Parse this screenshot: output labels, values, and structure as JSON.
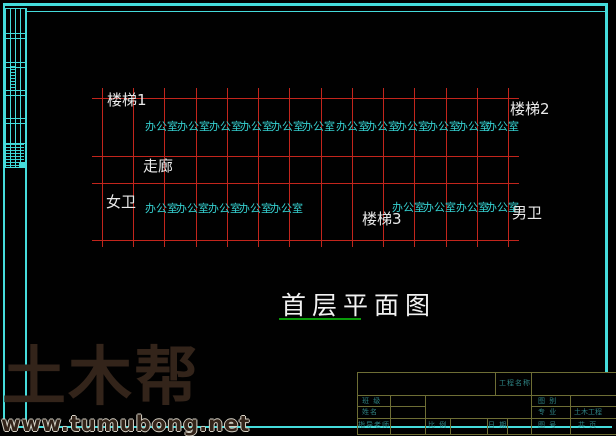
{
  "colors": {
    "frame_cyan": "#45dcdc",
    "grid_red": "#c2251c",
    "office_cyan": "#35cfcf",
    "label_white": "#eaeaea",
    "underline_green": "#0a9b0a",
    "block_line": "#6e6e35",
    "block_text": "#2f8484",
    "watermark_brown": "#33241a",
    "watermark_outline": "#d6d2c6"
  },
  "plan": {
    "grid": {
      "x_lines": [
        102,
        133,
        164,
        196,
        227,
        258,
        289,
        321,
        352,
        383,
        414,
        446,
        477,
        508
      ],
      "y_lines": [
        98,
        156,
        183,
        240
      ],
      "v_top": 88,
      "v_bottom": 247,
      "h_left": 92,
      "h_right": 519
    },
    "office_label": "办公室",
    "office_rows": [
      {
        "y": 121,
        "xs": [
          145,
          177,
          209,
          240,
          271,
          302,
          336,
          366,
          396,
          427,
          457,
          486
        ]
      },
      {
        "y": 203,
        "xs": [
          145,
          176,
          208,
          239,
          270
        ]
      },
      {
        "y": 202,
        "xs": [
          392,
          423,
          456,
          486
        ]
      }
    ],
    "room_labels": [
      {
        "id": "stair-1",
        "text": "楼梯1",
        "x": 107,
        "y": 92
      },
      {
        "id": "stair-2",
        "text": "楼梯2",
        "x": 510,
        "y": 101
      },
      {
        "id": "corridor",
        "text": "走廊",
        "x": 143,
        "y": 158
      },
      {
        "id": "female-wc",
        "text": "女卫",
        "x": 106,
        "y": 194
      },
      {
        "id": "stair-3",
        "text": "楼梯3",
        "x": 362,
        "y": 211
      },
      {
        "id": "male-wc",
        "text": "男卫",
        "x": 512,
        "y": 205
      }
    ],
    "title": {
      "text": "首层平面图",
      "x": 281,
      "y": 293,
      "underline_x": 279,
      "underline_y": 318,
      "underline_w": 82
    }
  },
  "title_block": {
    "project_name_label": "工程名称",
    "class_label": "班 级",
    "name_label": "姓名",
    "advisor_label": "指导老师",
    "scale_label": "比 例",
    "date_label": "日 期",
    "category_label": "图 别",
    "major_label": "专 业",
    "major_value": "土木工程",
    "number_label": "图 号",
    "pages_label": "共 页"
  },
  "watermark": {
    "logo": "土木帮",
    "url": "www.tumubong.net"
  }
}
